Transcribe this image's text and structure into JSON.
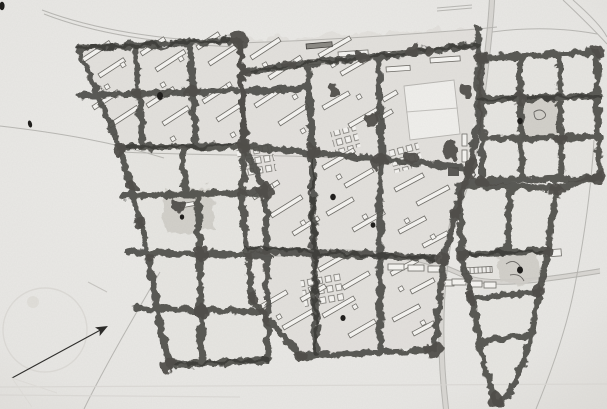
{
  "scene": {
    "label": "Scanned black-and-white urban master plan drawing",
    "description": "Hand-drawn site plan: residential superblocks of slab buildings enclosed by scalloped tree belts, a central school sports field, a nine-cell tree-lined garden grid at right, a tapering tree-bordered wedge at lower right, empty tree-bordered meadow cells at lower left, faint access roads, small ink ponds, and a thin north arrow with a faint survey circle at lower left."
  },
  "colors": {
    "paper": "#e9e8e5",
    "ground": "#e0deda",
    "cell": "#e7e5e1",
    "tree": "#4f4d49",
    "tree_dark": "#3a3835",
    "bldg": "#f5f4f1",
    "bstroke": "#6f6d68",
    "road": "#b4b2ae",
    "road_wide": "#d8d6d2",
    "shade": "#cfcdc8",
    "ink": "#1e1d1b",
    "faint": "#d9d7d3"
  }
}
